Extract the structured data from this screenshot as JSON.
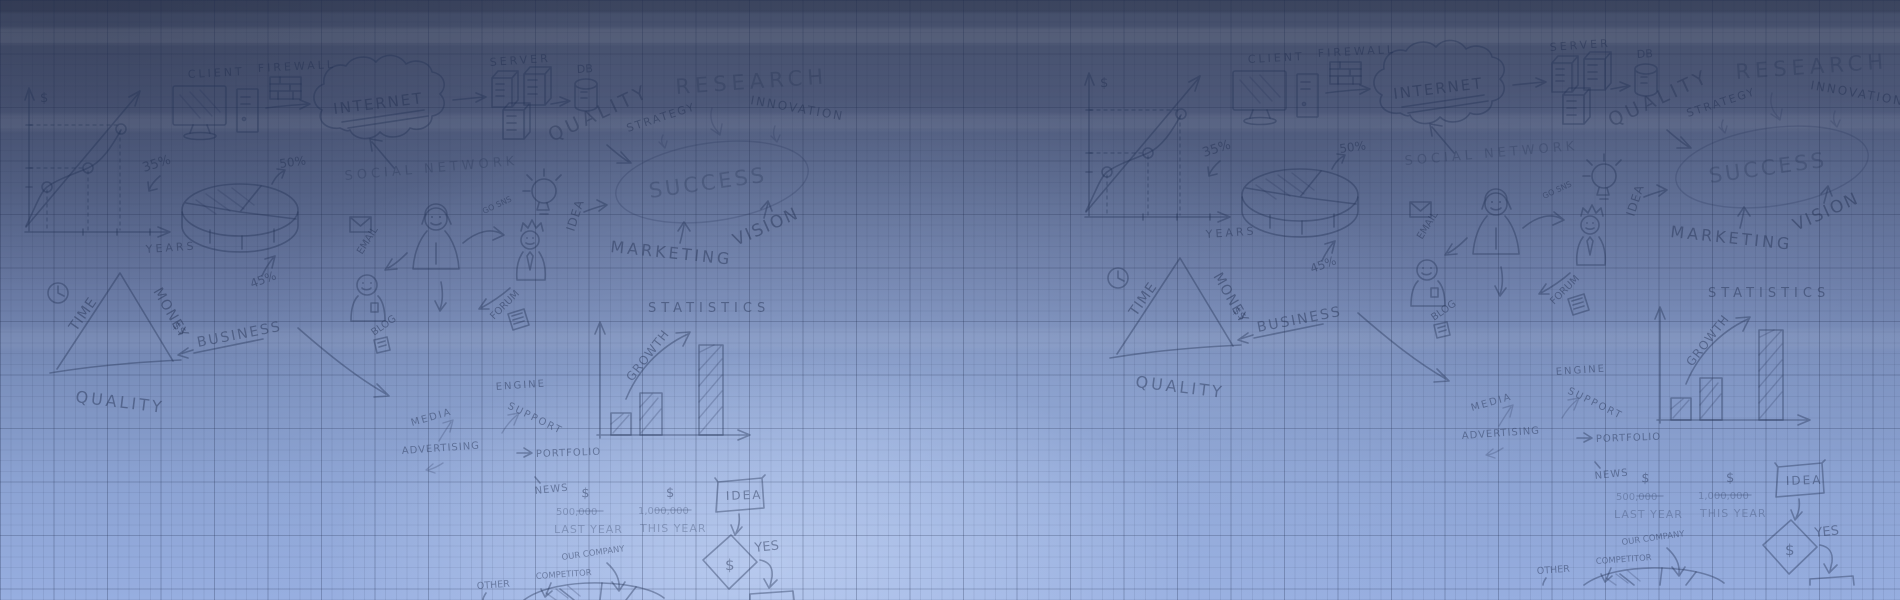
{
  "background": {
    "style": "graph-paper blueprint with hand-drawn business doodles, pattern repeated horizontally",
    "colors": {
      "gradient_top": "#444e69",
      "gradient_bottom": "#97aee0",
      "center_glow": "#d6e3fc",
      "grid_line": "#1e2a4b",
      "doodle_ink": "#243257"
    }
  },
  "doodles": {
    "labels": [
      {
        "id": "axis-dollar",
        "text": "$"
      },
      {
        "id": "years",
        "text": "YEARS"
      },
      {
        "id": "pct-35",
        "text": "35%"
      },
      {
        "id": "client",
        "text": "CLIENT"
      },
      {
        "id": "firewall",
        "text": "FIREWALL"
      },
      {
        "id": "internet",
        "text": "INTERNET"
      },
      {
        "id": "server",
        "text": "SERVER"
      },
      {
        "id": "db",
        "text": "DB"
      },
      {
        "id": "quality-top",
        "text": "QUALITY"
      },
      {
        "id": "research",
        "text": "RESEARCH"
      },
      {
        "id": "strategy",
        "text": "STRATEGY"
      },
      {
        "id": "innovation",
        "text": "INNOVATION"
      },
      {
        "id": "social-network",
        "text": "SOCIAL NETWORK"
      },
      {
        "id": "pct-50",
        "text": "50%"
      },
      {
        "id": "success",
        "text": "SUCCESS"
      },
      {
        "id": "vision",
        "text": "VISION"
      },
      {
        "id": "marketing",
        "text": "MARKETING"
      },
      {
        "id": "idea-rotated",
        "text": "IDEA"
      },
      {
        "id": "go-sns",
        "text": "GO SNS"
      },
      {
        "id": "email",
        "text": "EMAIL"
      },
      {
        "id": "time",
        "text": "TIME"
      },
      {
        "id": "money",
        "text": "MONEY"
      },
      {
        "id": "money-dollars",
        "text": "$$"
      },
      {
        "id": "quality-bottom",
        "text": "QUALITY"
      },
      {
        "id": "business",
        "text": "BUSINESS"
      },
      {
        "id": "pct-45",
        "text": "45%"
      },
      {
        "id": "forum",
        "text": "FORUM"
      },
      {
        "id": "blog",
        "text": "BLOG"
      },
      {
        "id": "engine",
        "text": "ENGINE"
      },
      {
        "id": "support",
        "text": "SUPPORT"
      },
      {
        "id": "media",
        "text": "MEDIA"
      },
      {
        "id": "advertising",
        "text": "ADVERTISING"
      },
      {
        "id": "portfolio",
        "text": "PORTFOLIO"
      },
      {
        "id": "news",
        "text": "NEWS"
      },
      {
        "id": "dollar-last",
        "text": "$"
      },
      {
        "id": "amount-last",
        "text": "500,000"
      },
      {
        "id": "last-year",
        "text": "LAST YEAR"
      },
      {
        "id": "dollar-this",
        "text": "$"
      },
      {
        "id": "amount-this",
        "text": "1,000,000"
      },
      {
        "id": "this-year",
        "text": "THIS YEAR"
      },
      {
        "id": "statistics",
        "text": "STATISTICS"
      },
      {
        "id": "growth",
        "text": "GROWTH"
      },
      {
        "id": "idea-box",
        "text": "IDEA"
      },
      {
        "id": "yes",
        "text": "YES"
      },
      {
        "id": "diamond-dollar",
        "text": "$"
      },
      {
        "id": "our-company",
        "text": "OUR COMPANY"
      },
      {
        "id": "competitor",
        "text": "COMPETITOR"
      },
      {
        "id": "other",
        "text": "OTHER"
      }
    ]
  }
}
